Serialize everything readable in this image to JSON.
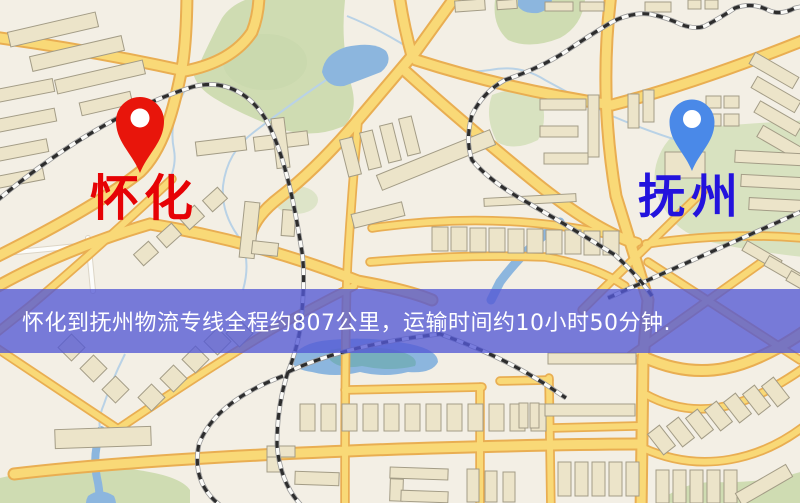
{
  "page": {
    "type": "static-route-map-graphic"
  },
  "map": {
    "origin": {
      "name": "怀化",
      "pin_icon": "map-pin-icon",
      "pin_color": "#e8150b",
      "label_color": "#e60205"
    },
    "destination": {
      "name": "抚州",
      "pin_icon": "map-pin-icon",
      "pin_color": "#4a89e8",
      "label_color": "#2313dd"
    },
    "banner": {
      "text": "怀化到抚州物流专线全程约807公里，运输时间约10小时50分钟.",
      "background_color": "rgba(83,88,213,0.78)",
      "text_color": "#ffffff"
    },
    "route_facts": {
      "distance_text": "约807公里",
      "duration_text": "约10小时50分钟"
    },
    "map_colors": {
      "background": "#f3efe5",
      "road_fill": "#f9d977",
      "road_casing": "#e9ae52",
      "water": "#8cb6de",
      "water_deep": "#64a8a2",
      "park": "#cfdcb2",
      "building": "#ece4c9",
      "building_outline": "#a39c86",
      "railway_dash": "#2d2d2d"
    }
  }
}
